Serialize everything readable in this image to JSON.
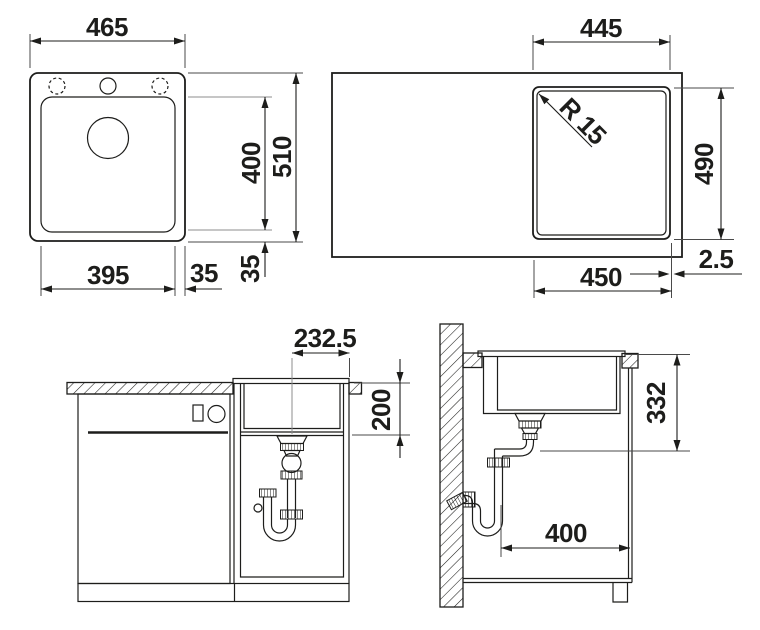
{
  "drawing": {
    "background": "#ffffff",
    "line_color": "#1d1d1b",
    "views": {
      "sink_top": {
        "name": "sink top view",
        "dims": {
          "overall_width": "465",
          "overall_depth": "510",
          "bowl_depth": "400",
          "bowl_width": "395",
          "rim_side": "35",
          "rim_front": "35"
        }
      },
      "cutout_plan": {
        "name": "worktop cutout plan",
        "dims": {
          "cutout_width": "445",
          "corner_radius": "R 15",
          "cutout_depth": "490",
          "bowl_outer_width": "450",
          "edge_clearance": "2.5"
        }
      },
      "cabinet_front": {
        "name": "cabinet front section",
        "dims": {
          "drain_center_offset": "232.5",
          "bowl_installed_depth": "200"
        }
      },
      "cabinet_side": {
        "name": "cabinet side section",
        "dims": {
          "outlet_height": "332",
          "outlet_distance": "400"
        }
      }
    }
  }
}
